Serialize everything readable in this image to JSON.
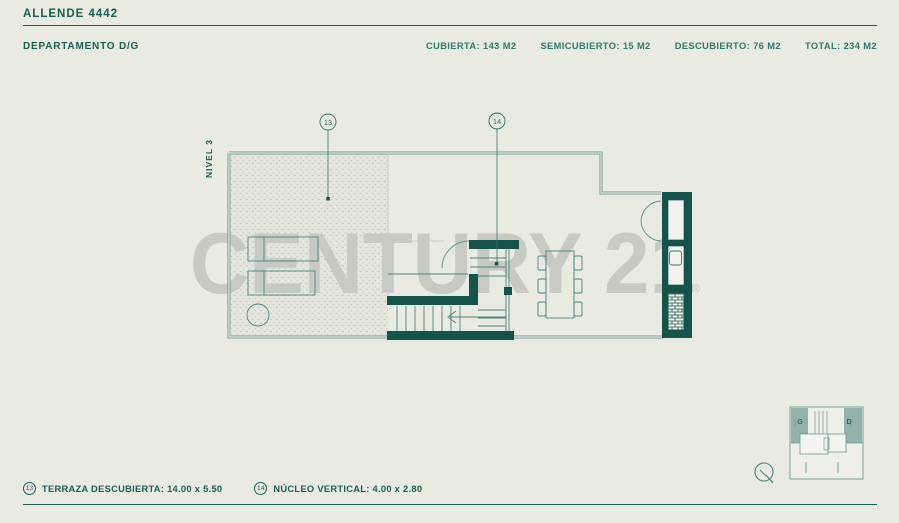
{
  "header": {
    "project_title": "ALLENDE 4442",
    "unit_title": "DEPARTAMENTO D/G",
    "stats": [
      {
        "label": "CUBIERTA:",
        "value": "143 M2"
      },
      {
        "label": "SEMICUBIERTO:",
        "value": "15 M2"
      },
      {
        "label": "DESCUBIERTO:",
        "value": "76 M2"
      },
      {
        "label": "TOTAL:",
        "value": "234 M2"
      }
    ]
  },
  "plan": {
    "level_label": "NIVEL 3",
    "callout_13": "13",
    "callout_14": "14",
    "watermark": "CENTURY 21",
    "registered_mark": "®"
  },
  "keyplan": {
    "left_unit_label": "G",
    "right_unit_label": "D"
  },
  "legend": {
    "items": [
      {
        "num": "13",
        "text": "TERRAZA DESCUBIERTA: 14.00 x 5.50"
      },
      {
        "num": "14",
        "text": "NÚCLEO VERTICAL: 4.00 x 2.80"
      }
    ]
  },
  "colors": {
    "background": "#e9eae2",
    "accent_text": "#176055",
    "wall_dark": "#14544b",
    "line_teal": "#5d948c",
    "watermark_gray": "#c7c9c3",
    "keyplan_fill": "#93b1ab"
  }
}
